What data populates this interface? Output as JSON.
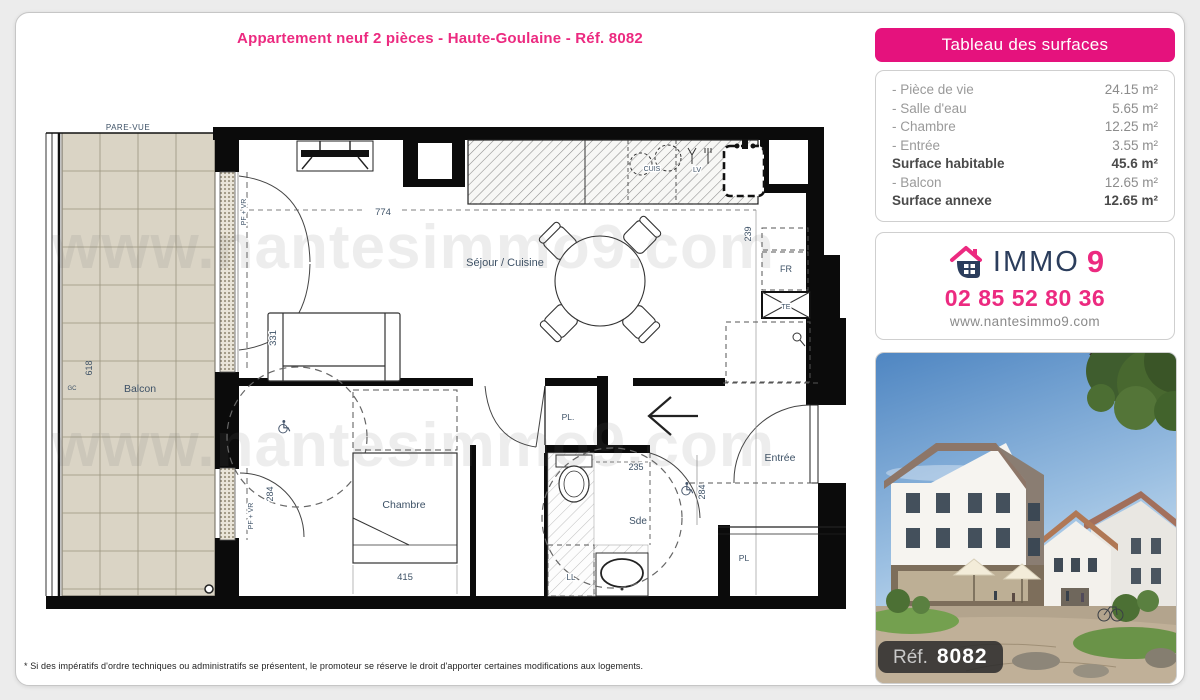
{
  "page": {
    "title": "Appartement neuf 2 pièces - Haute-Goulaine - Réf. 8082",
    "watermark": "www.nantesimmo9.com",
    "footnote": "* Si des impératifs d'ordre techniques ou administratifs se présentent, le promoteur se réserve le droit d'apporter certaines modifications aux logements."
  },
  "surfaces": {
    "header": "Tableau des surfaces",
    "rows": [
      {
        "label": "- Pièce de vie",
        "value": "24.15 m²"
      },
      {
        "label": "- Salle d'eau",
        "value": "5.65 m²"
      },
      {
        "label": "- Chambre",
        "value": "12.25 m²"
      },
      {
        "label": "- Entrée",
        "value": "3.55 m²"
      },
      {
        "label": "Surface habitable",
        "value": "45.6 m²"
      },
      {
        "label": "- Balcon",
        "value": "12.65 m²"
      },
      {
        "label": "Surface annexe",
        "value": "12.65 m²"
      }
    ]
  },
  "agency": {
    "brand_immo": "IMMO",
    "brand_9": "9",
    "phone": "02 85 52 80 36",
    "website": "www.nantesimmo9.com"
  },
  "photo": {
    "ref_label": "Réf.",
    "ref_value": "8082"
  },
  "plan": {
    "labels": {
      "pare_vue": "PARE-VUE",
      "balcon": "Balcon",
      "dim_618": "618",
      "gc": "GC",
      "pf_vr_sejour": "PF + VR",
      "dim_331": "331",
      "dim_774": "774",
      "cuis": "CUIS",
      "lv": "LV",
      "sejour": "Séjour / Cuisine",
      "dim_239": "239",
      "fr": "FR",
      "te": "TE",
      "pl_hall": "PL.",
      "entree": "Entrée",
      "dim_284_entree": "284",
      "sde": "Sde",
      "dim_235": "235",
      "ll": "LL",
      "chambre": "Chambre",
      "dim_415": "415",
      "dim_284_chambre": "284",
      "pf_vr_chambre": "PF + VR",
      "pl_entree": "PL"
    }
  },
  "colors": {
    "accent_pink": "#e5127d",
    "brand_navy": "#2b3d5c"
  }
}
